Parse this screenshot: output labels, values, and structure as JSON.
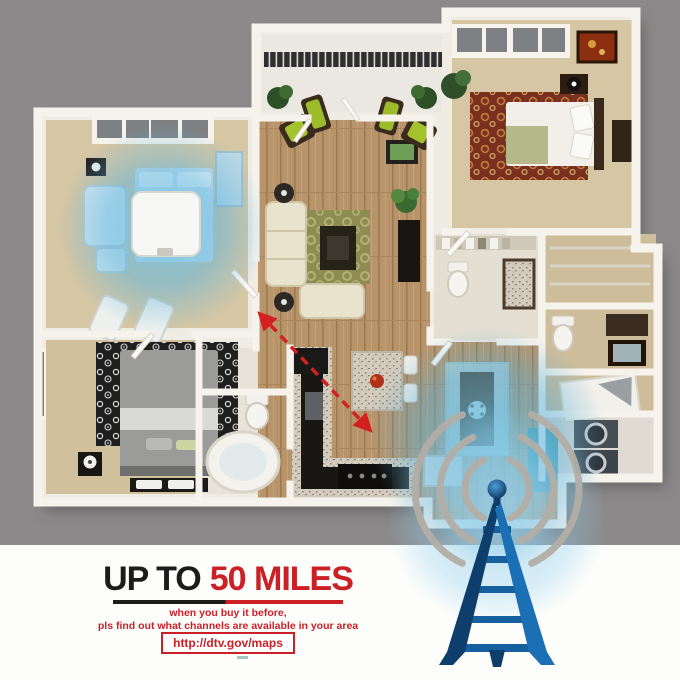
{
  "headline": {
    "prefix": "UP TO",
    "highlight": "50 MILES",
    "prefix_color": "#1c1c1c",
    "highlight_color": "#cb2026"
  },
  "subtext": {
    "line1": "when you buy it before,",
    "line2": "pls find out what channels are available in your area",
    "color": "#cb2026"
  },
  "cta": {
    "url": "http://dtv.gov/maps",
    "border_color": "#cb2026"
  },
  "colors": {
    "background_gray": "#8b8989",
    "panel_white": "#fdfdfc",
    "accent_red": "#cb2026",
    "tower_blue": "#1b6fb4",
    "tower_navy": "#0e3e6c",
    "coverage_glow_blue": "#6ec4e8",
    "signal_arc_gray": "#b3aea6",
    "wall_white": "#f6f3ec",
    "carpet_tan": "#d5c6a4",
    "hardwood_brown": "#b8946a"
  },
  "icons": {
    "tower": "broadcast-tower-icon",
    "signal": "signal-arcs-icon",
    "antenna_device": "flat-antenna-panel",
    "coverage": "wifi-coverage-glow",
    "range_arrow": "red-dashed-range-arrow"
  }
}
